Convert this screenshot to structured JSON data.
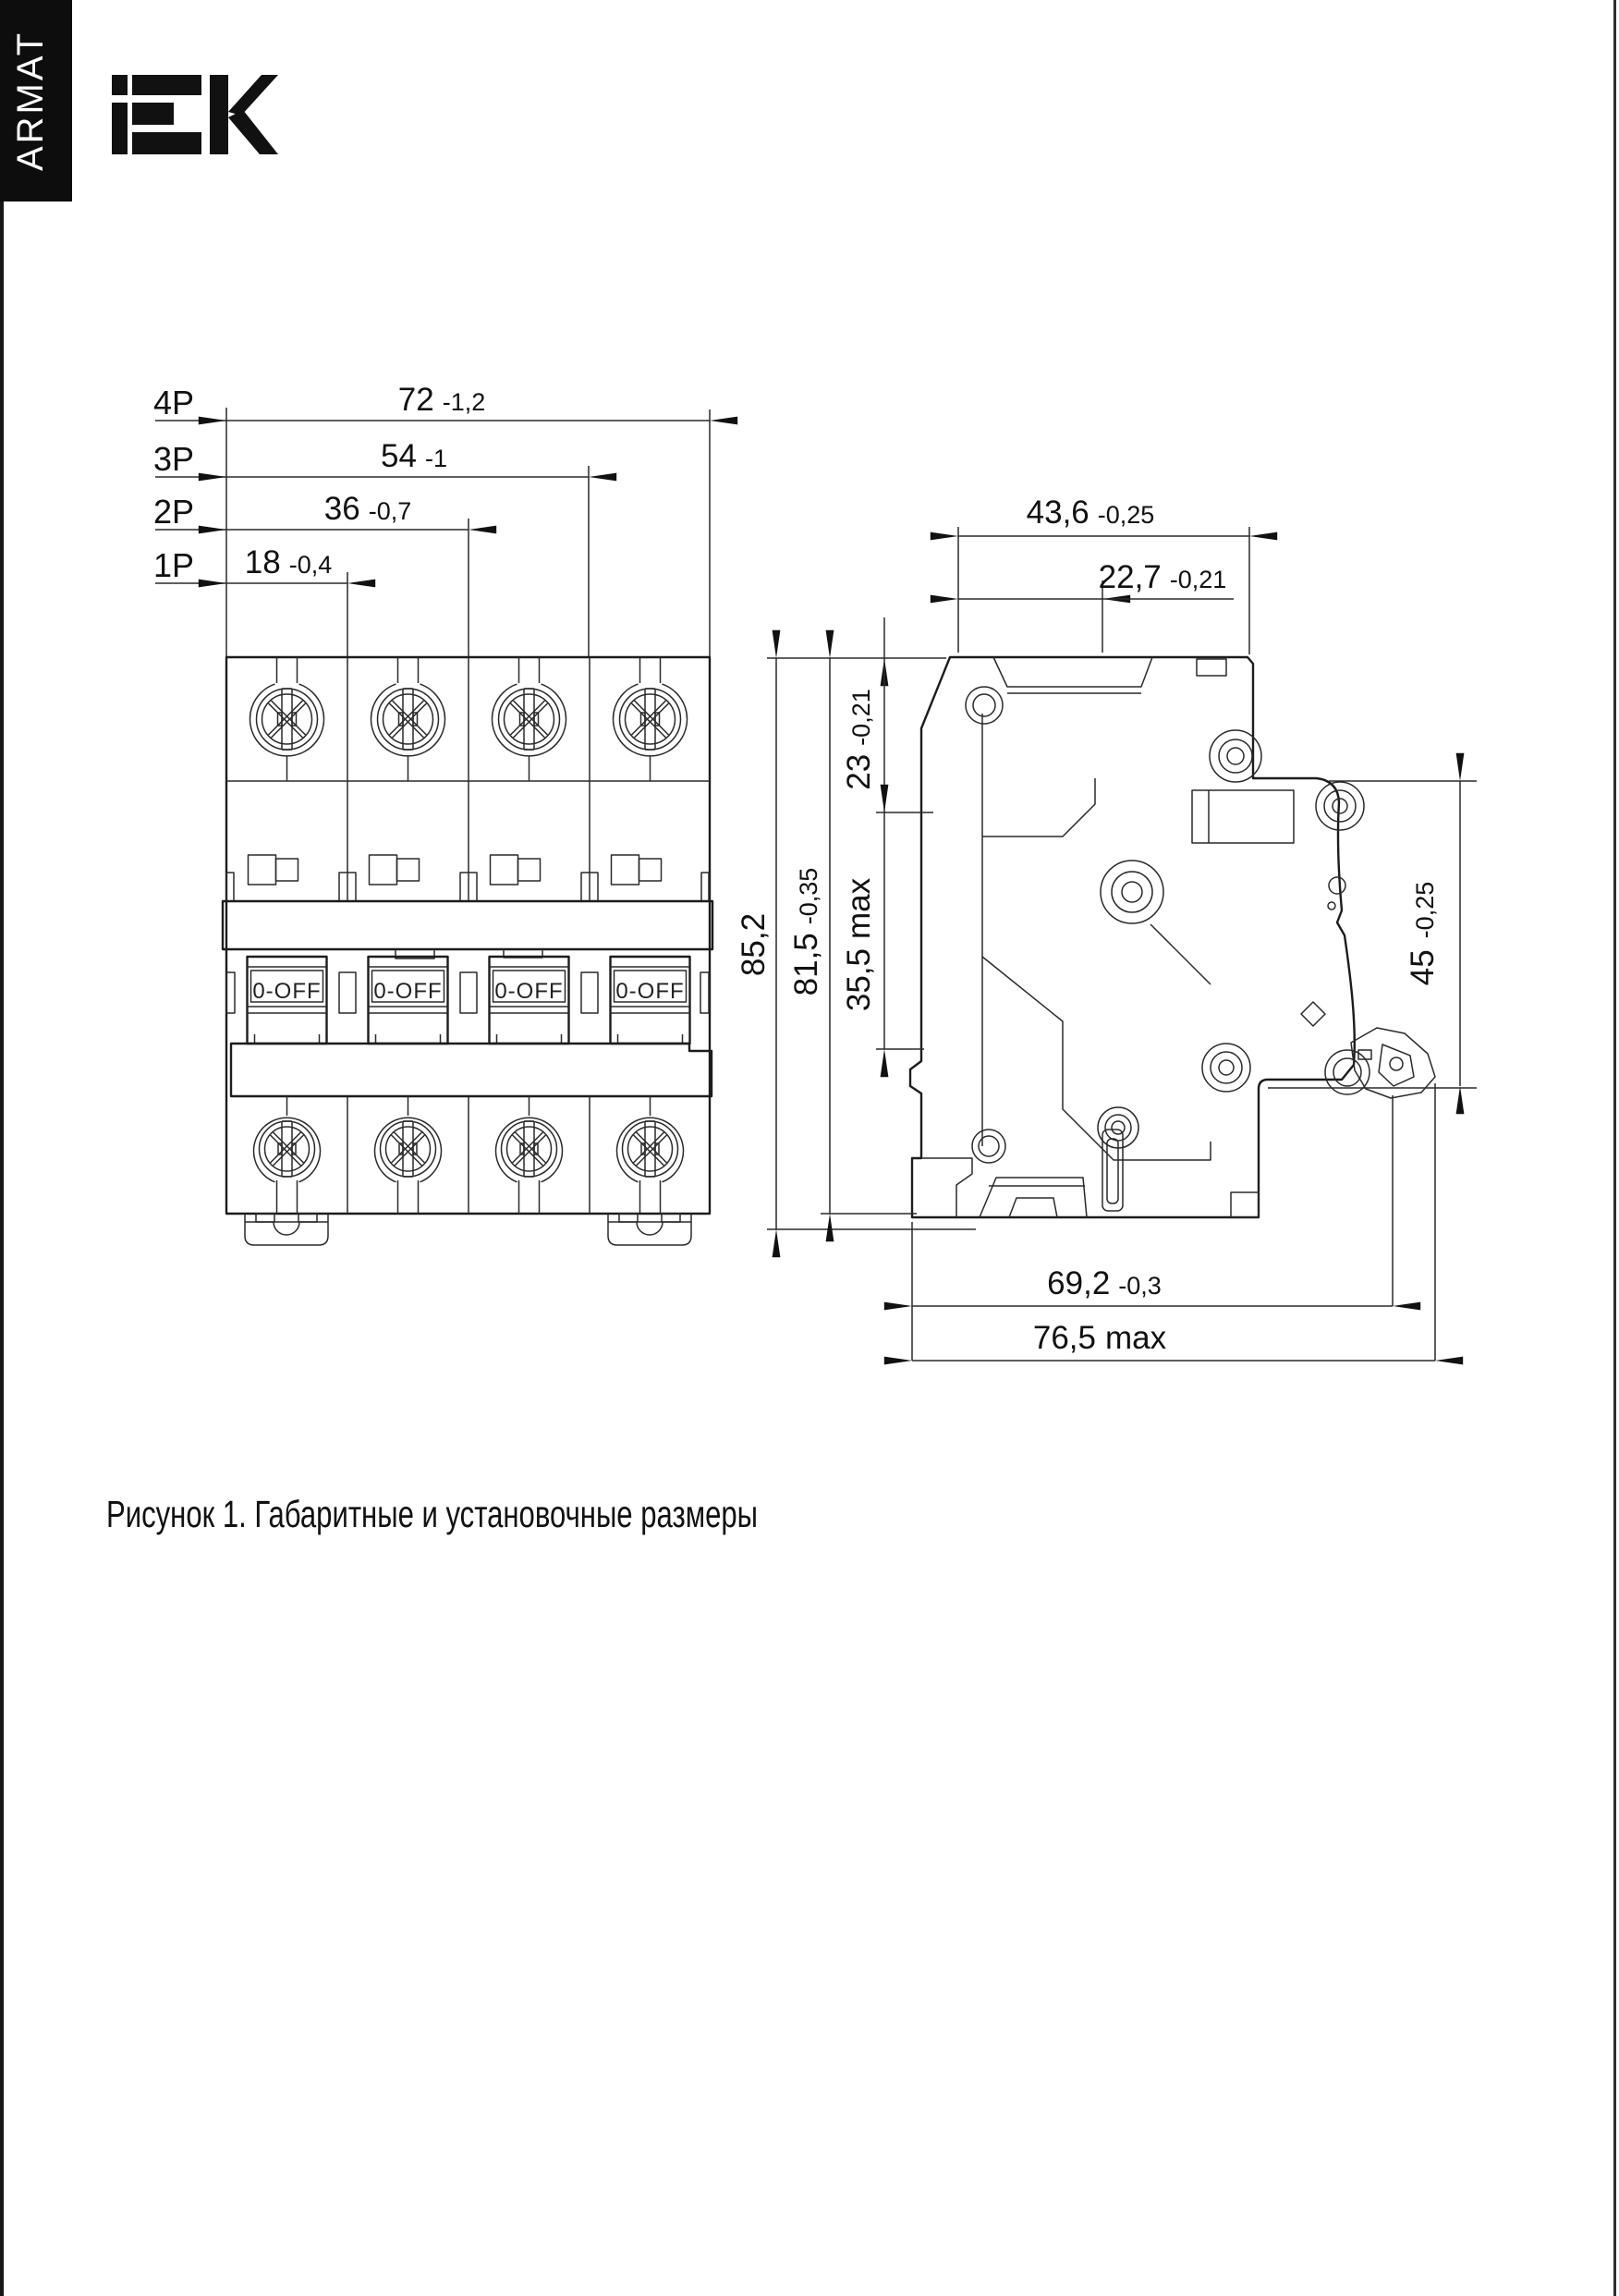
{
  "header": {
    "sidebar_brand": "ARMAT",
    "logo": "IEK"
  },
  "caption": {
    "text": "Рисунок 1. Габаритные и установочные размеры"
  },
  "front_view": {
    "rows": [
      {
        "label": "4P",
        "value": "72",
        "tol": "-1,2"
      },
      {
        "label": "3P",
        "value": "54",
        "tol": "-1"
      },
      {
        "label": "2P",
        "value": "36",
        "tol": "-0,7"
      },
      {
        "label": "1P",
        "value": "18",
        "tol": "-0,4"
      }
    ],
    "handles": [
      "0-OFF",
      "0-OFF",
      "0-OFF",
      "0-OFF"
    ]
  },
  "side_view": {
    "dims": {
      "top_width": {
        "value": "43,6",
        "tol": "-0,25"
      },
      "terminal_width": {
        "value": "22,7",
        "tol": "-0,21"
      },
      "terminal_depth": {
        "value": "23",
        "tol": "-0,21"
      },
      "mid_depth": {
        "value": "35,5",
        "suffix": "max"
      },
      "body_height": {
        "value": "81,5",
        "tol": "-0,35"
      },
      "total_height": {
        "value": "85,2"
      },
      "din_recess": {
        "value": "45",
        "tol": "-0,25"
      },
      "body_depth": {
        "value": "69,2",
        "tol": "-0,3"
      },
      "max_depth": {
        "value": "76,5",
        "suffix": "max"
      }
    }
  }
}
